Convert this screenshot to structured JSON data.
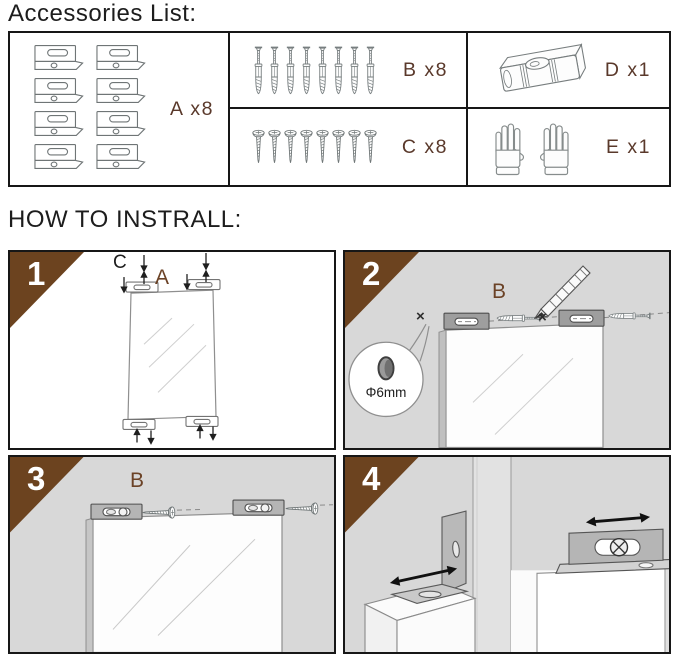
{
  "titles": {
    "accessories": "Accessories List:",
    "install": "HOW TO INSTRALL:"
  },
  "accessories": {
    "items": [
      {
        "id": "A",
        "label": "A x8",
        "name": "mounting-bracket",
        "count": 8
      },
      {
        "id": "B",
        "label": "B x8",
        "name": "wall-anchor",
        "count": 8
      },
      {
        "id": "C",
        "label": "C x8",
        "name": "screw",
        "count": 8
      },
      {
        "id": "D",
        "label": "D x1",
        "name": "spirit-level",
        "count": 1
      },
      {
        "id": "E",
        "label": "E x1",
        "name": "gloves",
        "count": 1
      }
    ]
  },
  "steps": [
    {
      "number": "1",
      "labels": {
        "screw": "C",
        "bracket": "A"
      }
    },
    {
      "number": "2",
      "labels": {
        "bracket": "B",
        "hole": "Φ6mm",
        "mark_left": "×",
        "mark_right": "×"
      }
    },
    {
      "number": "3",
      "labels": {
        "bracket": "B"
      }
    },
    {
      "number": "4",
      "labels": {}
    }
  ],
  "colors": {
    "accent_brown": "#6C431F",
    "label_brown": "#5A392B",
    "wall_gray": "#D8D8D8",
    "panel_border": "#171717"
  }
}
